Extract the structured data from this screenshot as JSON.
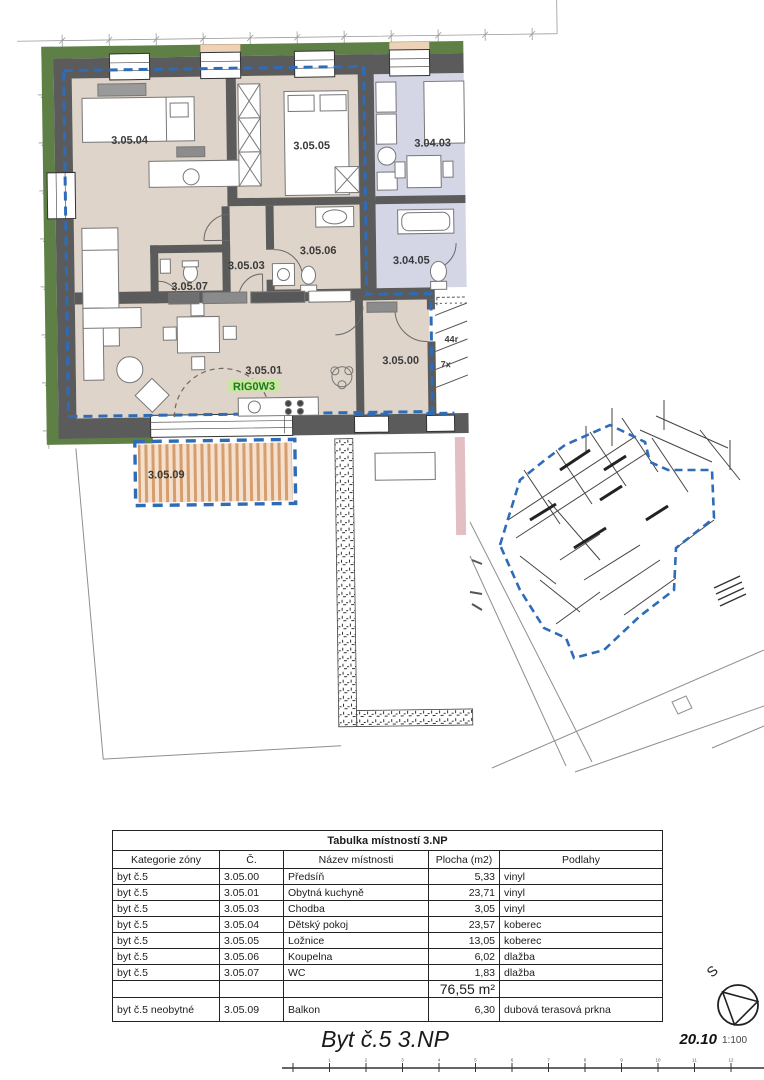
{
  "plan": {
    "labels": {
      "room_305_04": "3.05.04",
      "room_305_05": "3.05.05",
      "room_304_03": "3.04.03",
      "room_305_06": "3.05.06",
      "room_305_03": "3.05.03",
      "room_304_05": "3.04.05",
      "room_305_07": "3.05.07",
      "room_305_01": "3.05.01",
      "rig_tag": "RIG0W3",
      "room_305_00": "3.05.00",
      "room_305_09": "3.05.09",
      "stair_note_1": "44r",
      "stair_note_2": "7x"
    },
    "colors": {
      "apartment_floor": "#ded4c9",
      "neighbor_floor": "#d4d6e6",
      "wall": "#5b5b5b",
      "facade_green": "#5e7f45",
      "boundary_blue": "#2e6cb8",
      "deck_stripe": "#d59e6f",
      "deck_bg": "#f4e0cc",
      "rig_green": "#1d7a1d",
      "rig_bg": "#c9e6a1"
    }
  },
  "table": {
    "title": "Tabulka místností 3.NP",
    "headers": [
      "Kategorie zóny",
      "Č.",
      "Název místnosti",
      "Plocha (m2)",
      "Podlahy"
    ],
    "rows": [
      {
        "category": "byt č.5",
        "num": "3.05.00",
        "name": "Předsíň",
        "area": "5,33",
        "floor": "vinyl"
      },
      {
        "category": "byt č.5",
        "num": "3.05.01",
        "name": "Obytná kuchyně",
        "area": "23,71",
        "floor": "vinyl"
      },
      {
        "category": "byt č.5",
        "num": "3.05.03",
        "name": "Chodba",
        "area": "3,05",
        "floor": "vinyl"
      },
      {
        "category": "byt č.5",
        "num": "3.05.04",
        "name": "Dětský pokoj",
        "area": "23,57",
        "floor": "koberec"
      },
      {
        "category": "byt č.5",
        "num": "3.05.05",
        "name": "Ložnice",
        "area": "13,05",
        "floor": "koberec"
      },
      {
        "category": "byt č.5",
        "num": "3.05.06",
        "name": "Koupelna",
        "area": "6,02",
        "floor": "dlažba"
      },
      {
        "category": "byt č.5",
        "num": "3.05.07",
        "name": "WC",
        "area": "1,83",
        "floor": "dlažba"
      }
    ],
    "total_area": "76,55 m²",
    "balcony_row": {
      "category": "byt č.5 neobytné",
      "num": "3.05.09",
      "name": "Balkon",
      "area": "6,30",
      "floor": "dubová terasová prkna"
    }
  },
  "title_block": {
    "title": "Byt č.5 3.NP",
    "drawing_number": "20.10",
    "scale": "1:100"
  },
  "compass": {
    "north_letter": "S"
  },
  "scalebar": {
    "labels": [
      "1",
      "2",
      "3",
      "4",
      "5",
      "6",
      "7",
      "8",
      "9",
      "10",
      "11",
      "12"
    ]
  }
}
